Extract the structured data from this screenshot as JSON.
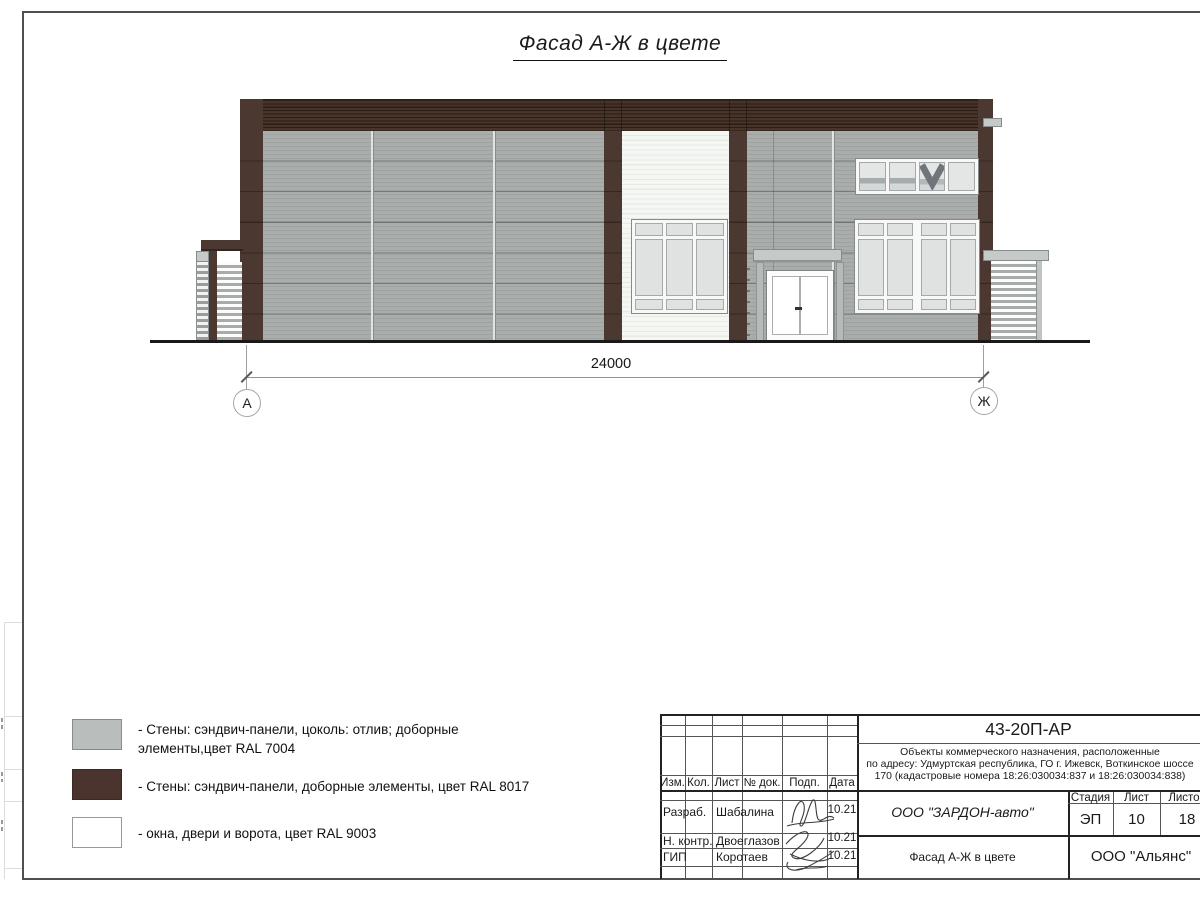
{
  "title": "Фасад А-Ж в цвете",
  "dimension_label": "24000",
  "axes": {
    "left": "А",
    "right": "Ж"
  },
  "colors": {
    "ral7004_gray": "#a6aba9",
    "ral8017_brown": "#4b3831",
    "ral9003_white": "#ffffff"
  },
  "legend": {
    "items": [
      {
        "swatch": "#b9bdbc",
        "label": "- Стены: сэндвич-панели, цоколь: отлив; доборные элементы,цвет RAL 7004"
      },
      {
        "swatch": "#4b342d",
        "label": "- Стены: сэндвич-панели, доборные элементы, цвет RAL 8017"
      },
      {
        "swatch": "#ffffff",
        "label": "- окна, двери и ворота, цвет RAL 9003"
      }
    ]
  },
  "titleblock": {
    "doc_code": "43-20П-АР",
    "project_lines": [
      "Объекты коммерческого назначения, расположенные",
      "по адресу: Удмуртская республика, ГО г. Ижевск, Воткинское шоссе",
      "170 (кадастровые номера 18:26:030034:837 и 18:26:030034:838)"
    ],
    "col_labels": [
      "Изм.",
      "Кол.",
      "Лист",
      "№ док.",
      "Подп.",
      "Дата"
    ],
    "rows": [
      {
        "role": "Разраб.",
        "name": "Шабалина",
        "date": "10.21"
      },
      {
        "role": "Н. контр.",
        "name": "Двоеглазов",
        "date": "10.21"
      },
      {
        "role": "ГИП",
        "name": "Коротаев",
        "date": "10.21"
      }
    ],
    "company": "ООО \"ЗАРДОН-авто\"",
    "stage_label": "Стадия",
    "sheet_label": "Лист",
    "sheets_label": "Листов",
    "stage": "ЭП",
    "sheet": "10",
    "sheets": "18",
    "drawing_name": "Фасад А-Ж в цвете",
    "org": "ООО \"Альянс\""
  }
}
